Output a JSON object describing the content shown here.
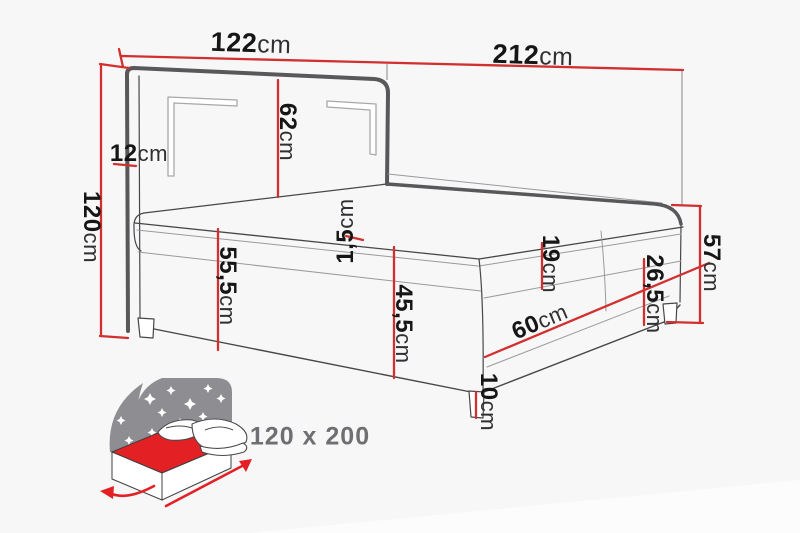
{
  "colors": {
    "background": "#f7f7f8",
    "dimension_red": "#d22f2f",
    "line_dark": "#47474a",
    "line_thick": "#58585a",
    "line_light": "#9a9a9d",
    "icon_grey": "#8e8e92",
    "icon_red": "#e32125",
    "label_text": "#161616",
    "size_label_grey": "#6f6f73"
  },
  "dimension_labels": [
    {
      "id": "headboard-width",
      "num": "122",
      "unit": "cm"
    },
    {
      "id": "bed-total-length",
      "num": "212",
      "unit": "cm"
    },
    {
      "id": "headboard-height",
      "num": "120",
      "unit": "cm"
    },
    {
      "id": "headboard-depth",
      "num": "12",
      "unit": "cm"
    },
    {
      "id": "headboard-panel",
      "num": "62",
      "unit": "cm"
    },
    {
      "id": "topper-thickness",
      "num": "1,5",
      "unit": "cm"
    },
    {
      "id": "front-height",
      "num": "55,5",
      "unit": "cm"
    },
    {
      "id": "side-height",
      "num": "45,5",
      "unit": "cm"
    },
    {
      "id": "mattress-height",
      "num": "19",
      "unit": "cm"
    },
    {
      "id": "box-height",
      "num": "26,5",
      "unit": "cm"
    },
    {
      "id": "foot-total-height",
      "num": "57",
      "unit": "cm"
    },
    {
      "id": "drawer-depth",
      "num": "60",
      "unit": "cm"
    },
    {
      "id": "leg-height",
      "num": "10",
      "unit": "cm"
    }
  ],
  "size_label": "120 x 200"
}
